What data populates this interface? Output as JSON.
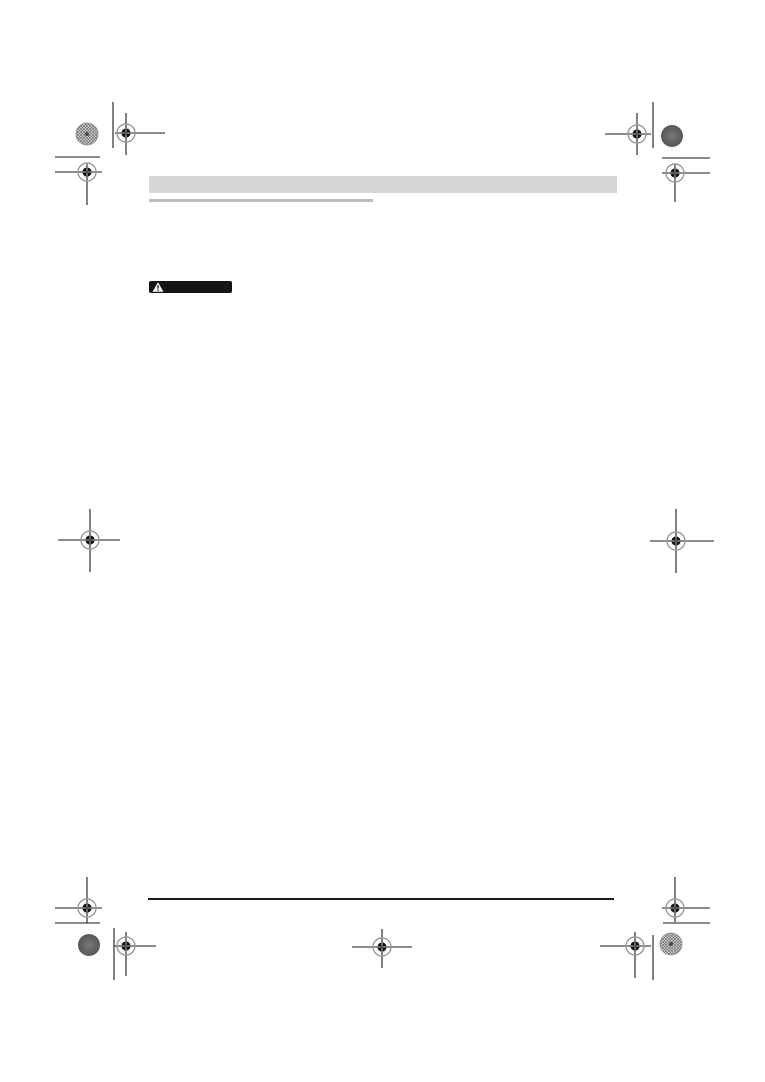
{
  "document": {
    "background_color": "#ffffff"
  },
  "header": {
    "title": "",
    "bar_color": "#d6d6d6",
    "underline_color": "#bcbcbc"
  },
  "warning_label": {
    "text": "",
    "background_color": "#151515",
    "icon": "warning-triangle-icon",
    "icon_color": "#ffffff"
  },
  "footer": {
    "rule_color": "#1c1c1c"
  },
  "print_marks": {
    "mark_color": "#1a1a1a",
    "registration_mark_icon": "crosshair-in-circle",
    "color_patch_icon": "filled-circle",
    "registration_marks_count": 11,
    "color_patches_count": 4,
    "trim_lines_count": 8
  }
}
